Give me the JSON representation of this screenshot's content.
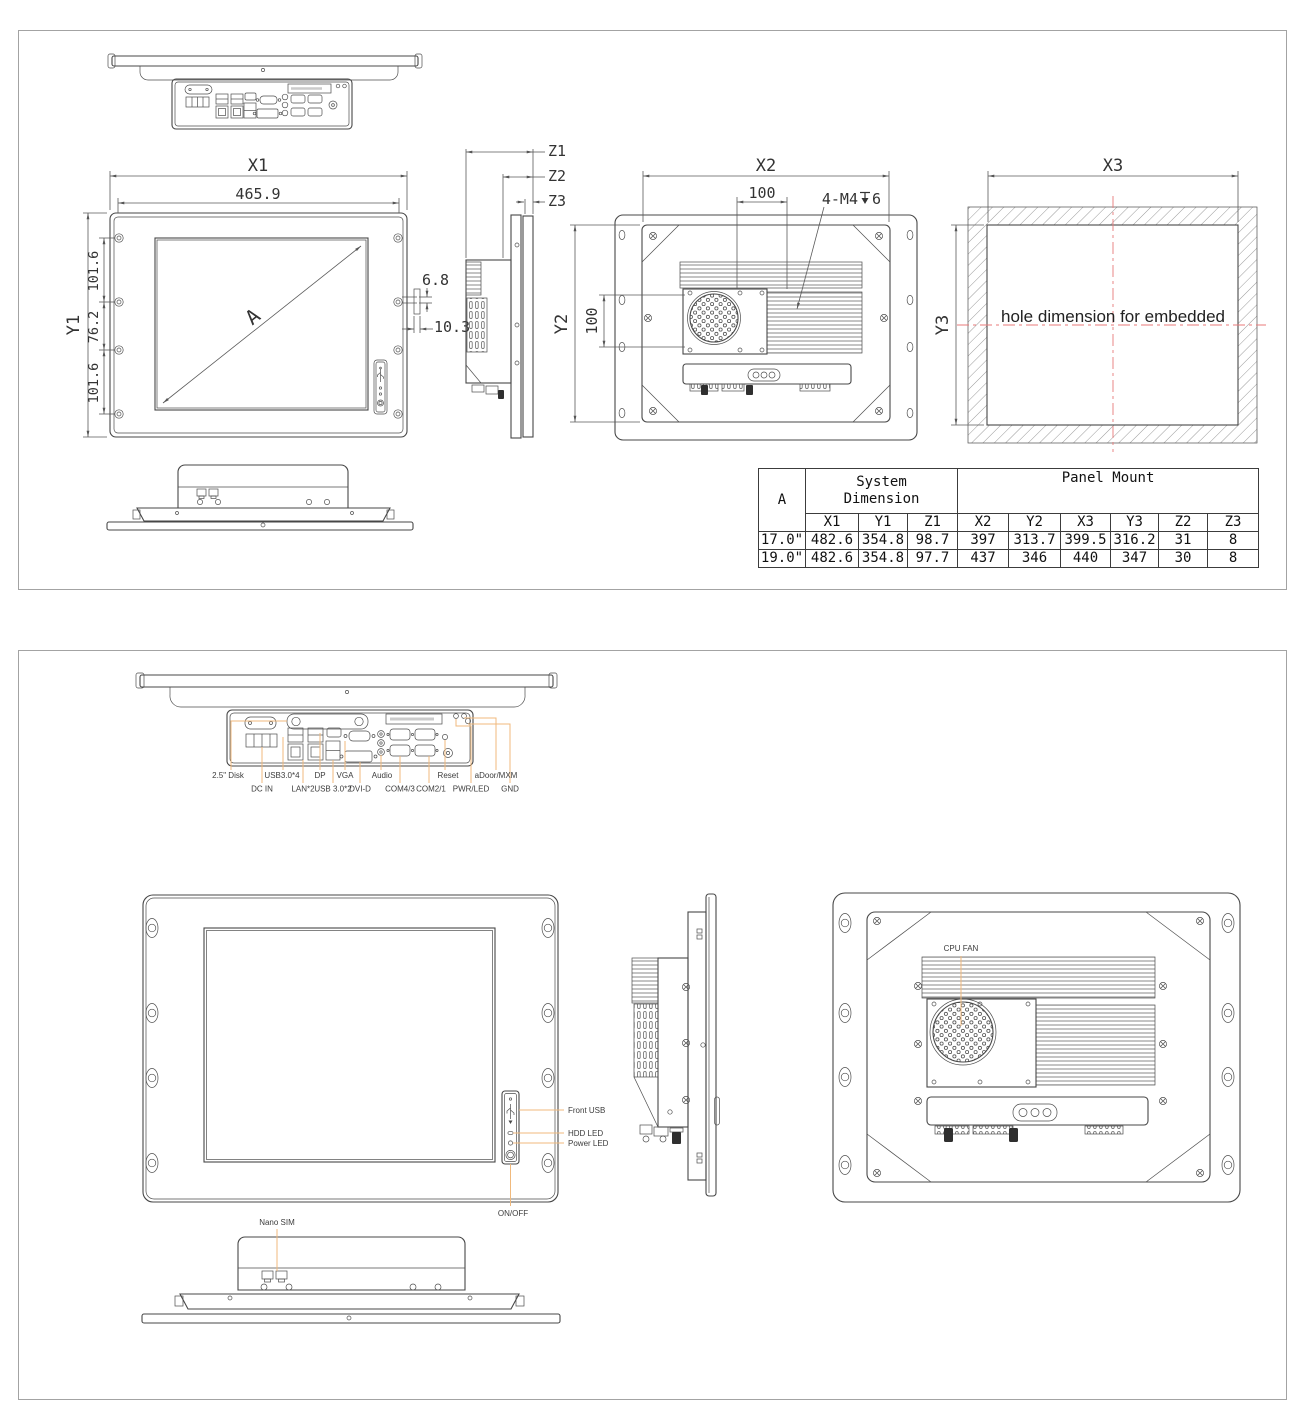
{
  "colors": {
    "line": "#474747",
    "dimension": "#5a5a5a",
    "callout": "#f0b97c",
    "centerline": "#e87a7a"
  },
  "sheet1": {
    "front": {
      "x1": "X1",
      "width_465": "465.9",
      "y1": "Y1",
      "chain": [
        "101.6",
        "76.2",
        "101.6"
      ],
      "diag": "A",
      "dim_68": "6.8",
      "dim_103": "10.3"
    },
    "side": {
      "z1": "Z1",
      "z2": "Z2",
      "z3": "Z3"
    },
    "rear": {
      "x2": "X2",
      "y2": "Y2",
      "dim_100h": "100",
      "dim_100v": "100",
      "thread_prefix": "4-M4",
      "thread_depth": "6"
    },
    "embedded": {
      "x3": "X3",
      "y3": "Y3",
      "note": "hole dimension for embedded"
    },
    "table": {
      "col_a": "A",
      "group_system": "System Dimension",
      "group_panel": "Panel Mount",
      "headers": [
        "X1",
        "Y1",
        "Z1",
        "X2",
        "Y2",
        "X3",
        "Y3",
        "Z2",
        "Z3"
      ],
      "rows": [
        {
          "size": "17.0\"",
          "values": [
            "482.6",
            "354.8",
            "98.7",
            "397",
            "313.7",
            "399.5",
            "316.2",
            "31",
            "8"
          ]
        },
        {
          "size": "19.0\"",
          "values": [
            "482.6",
            "354.8",
            "97.7",
            "437",
            "346",
            "440",
            "347",
            "30",
            "8"
          ]
        }
      ]
    }
  },
  "sheet2": {
    "io_row1": [
      "2.5\" Disk",
      "USB3.0*4",
      "DP",
      "VGA",
      "Audio",
      "Reset",
      "aDoor/MXM"
    ],
    "io_row2": [
      "DC IN",
      "LAN*2",
      "USB 3.0*2",
      "DVI-D",
      "COM4/3",
      "COM2/1",
      "PWR/LED",
      "GND"
    ],
    "front": {
      "front_usb": "Front USB",
      "hdd_led": "HDD LED",
      "power_led": "Power LED",
      "on_off": "ON/OFF"
    },
    "rear": {
      "cpu_fan": "CPU FAN"
    },
    "bottom": {
      "nano_sim": "Nano SIM"
    }
  }
}
